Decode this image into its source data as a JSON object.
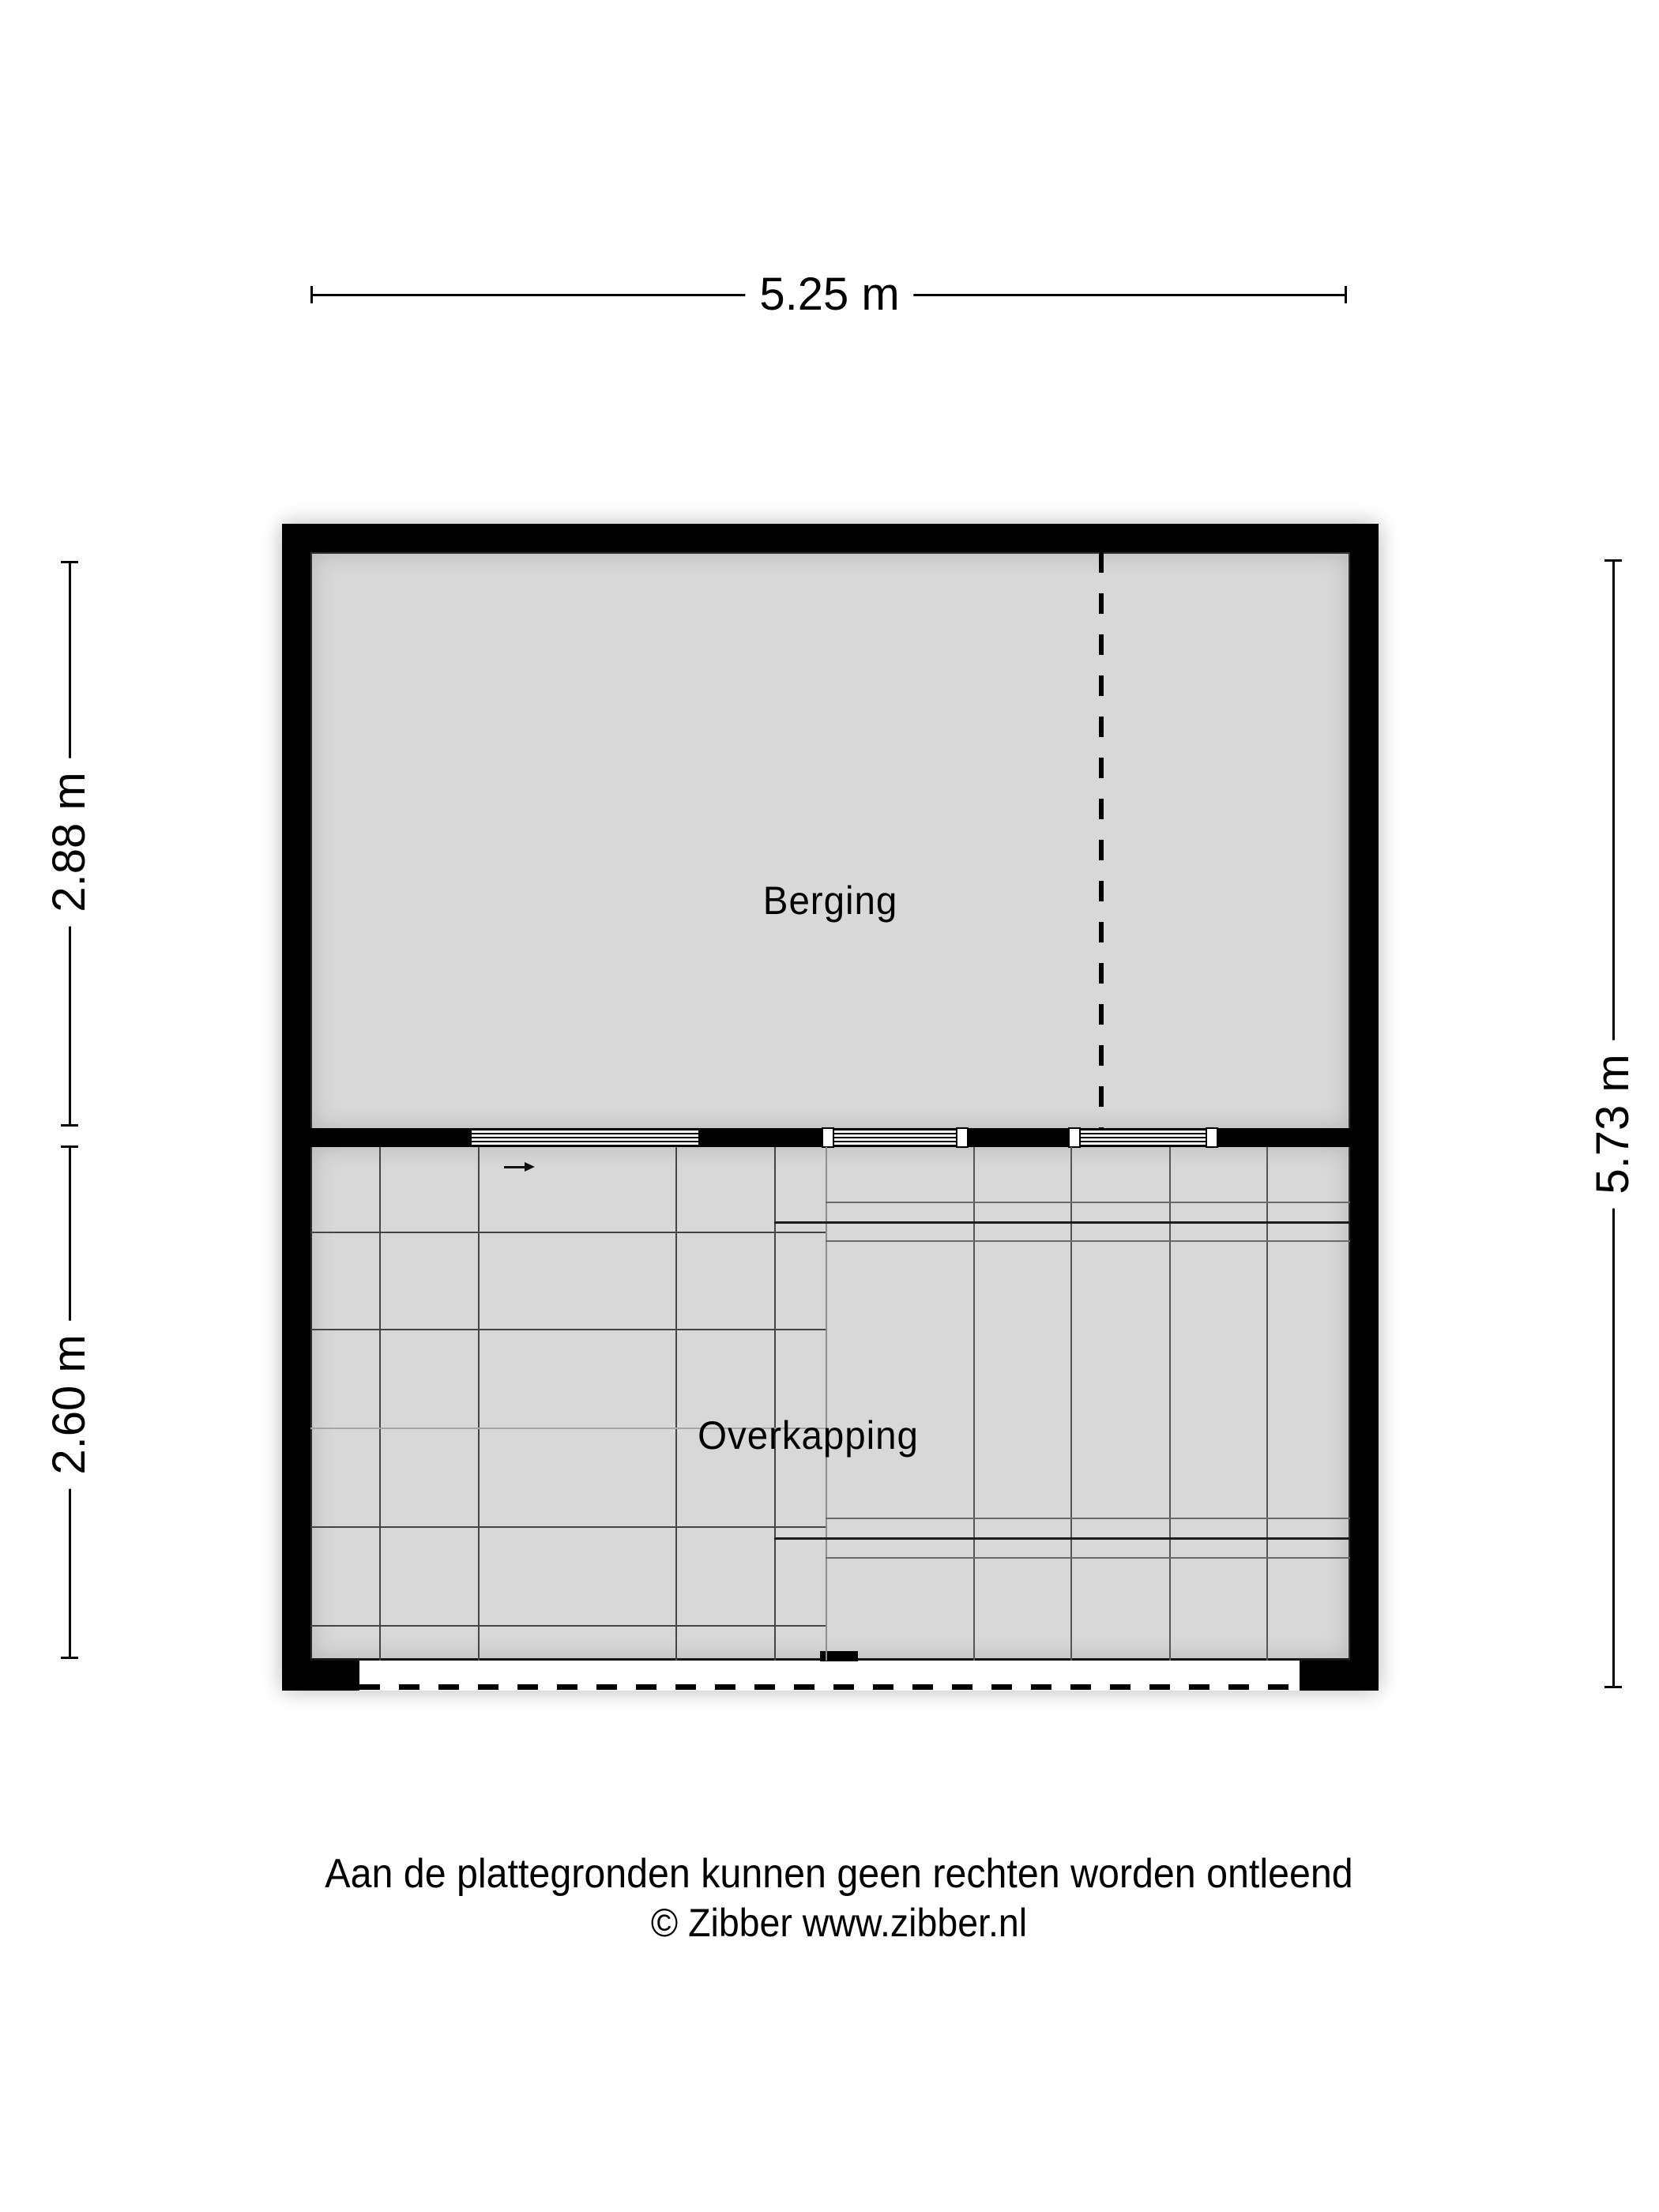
{
  "dimensions": {
    "top": "5.25 m",
    "left_upper": "2.88 m",
    "left_lower": "2.60 m",
    "right": "5.73 m"
  },
  "rooms": {
    "berging_label": "Berging",
    "overkapping_label": "Overkapping"
  },
  "footer": {
    "disclaimer": "Aan de plattegronden kunnen geen rechten worden ontleend",
    "copyright": "© Zibber www.zibber.nl"
  },
  "colors": {
    "background": "#ffffff",
    "wall": "#000000",
    "floor": "#d8d8d8",
    "grid_line": "#444444",
    "text": "#000000"
  },
  "icons": {
    "entry_arrow": "right-arrow"
  }
}
